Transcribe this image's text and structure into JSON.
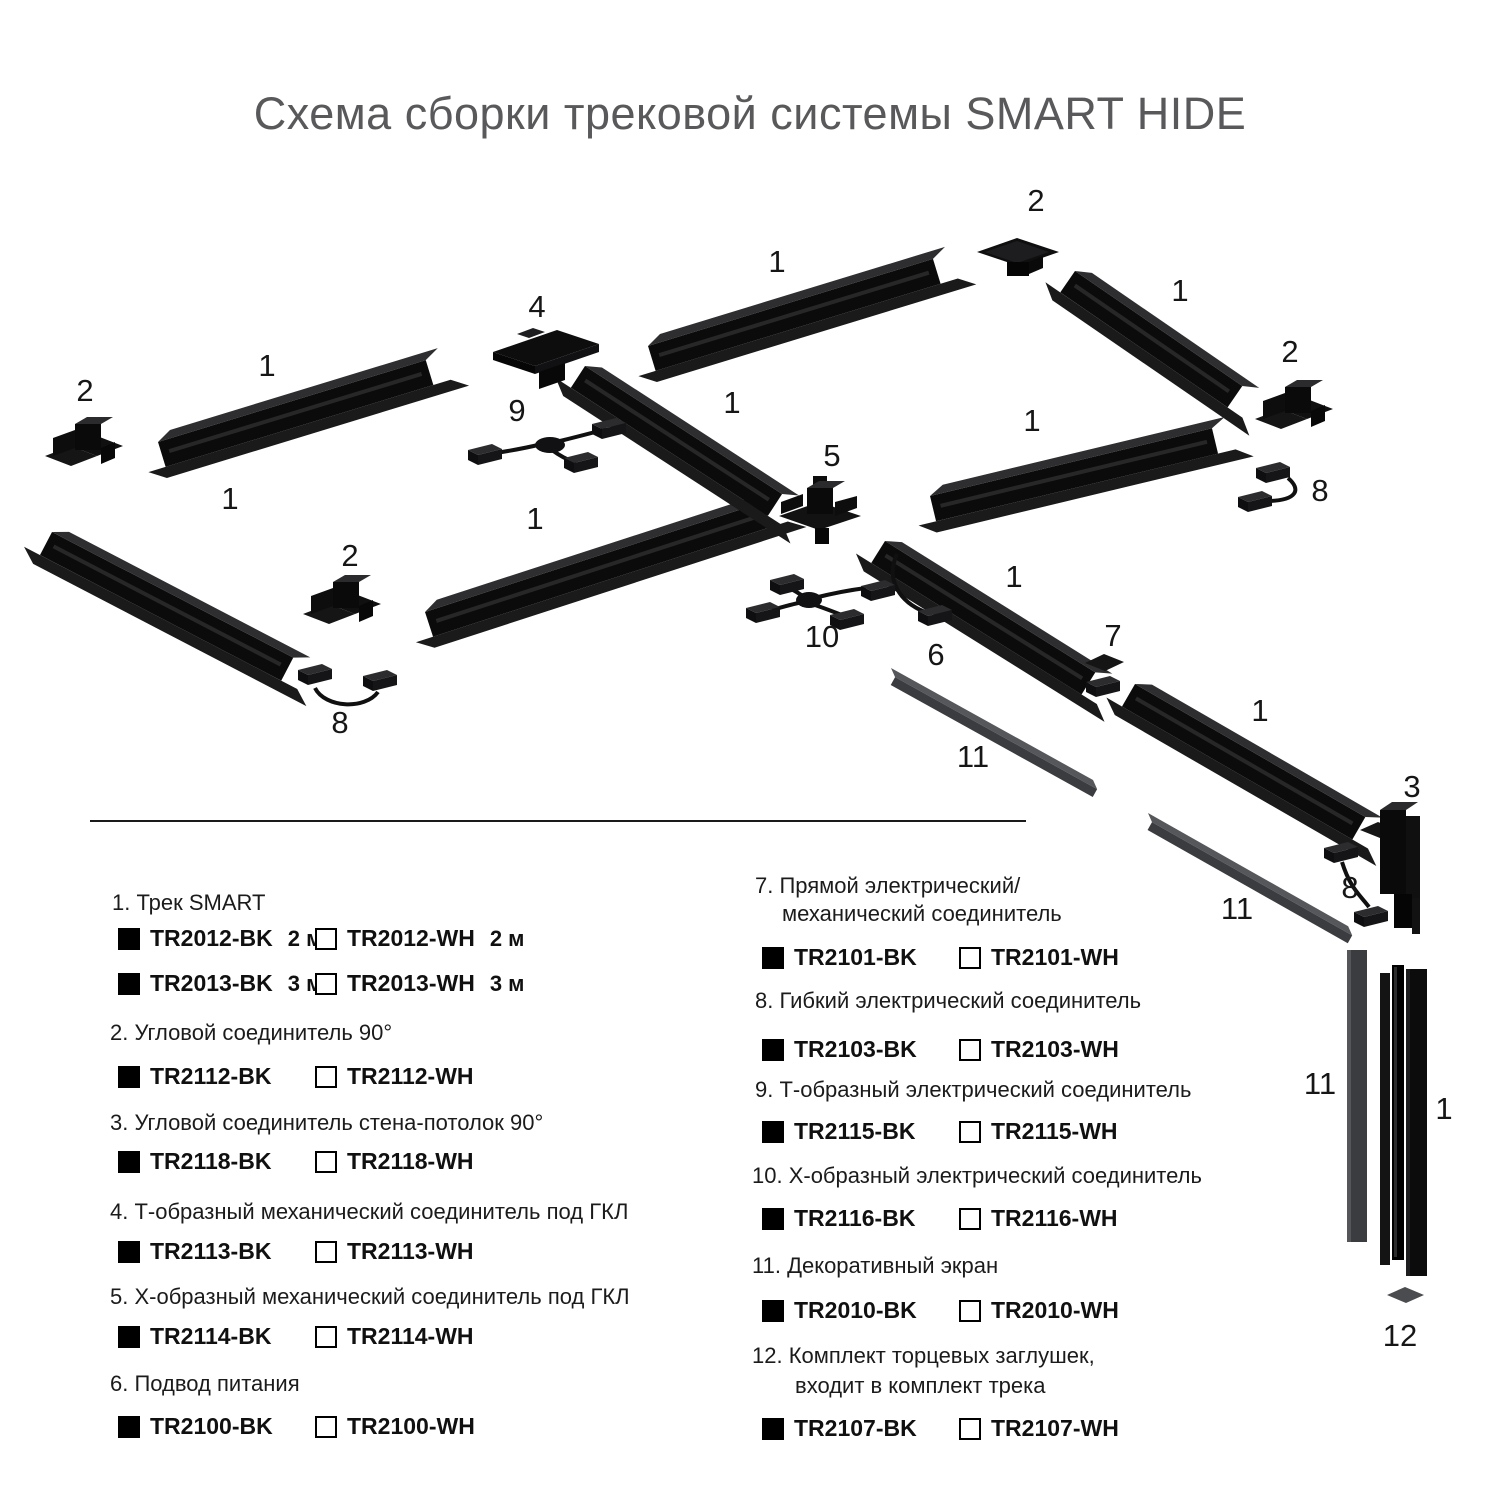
{
  "title": "Схема сборки трековой системы SMART HIDE",
  "colors": {
    "track_black": "#0b0b0b",
    "screen_gray": "#3b3c3f",
    "title_gray": "#59595b",
    "text_dark": "#1b1b1b"
  },
  "diagram": {
    "labels": [
      {
        "text": "2"
      },
      {
        "text": "1"
      },
      {
        "text": "1"
      },
      {
        "text": "4"
      },
      {
        "text": "2"
      },
      {
        "text": "1"
      },
      {
        "text": "2"
      },
      {
        "text": "1"
      },
      {
        "text": "9"
      },
      {
        "text": "1"
      },
      {
        "text": "5"
      },
      {
        "text": "8"
      },
      {
        "text": "1"
      },
      {
        "text": "1"
      },
      {
        "text": "2"
      },
      {
        "text": "1"
      },
      {
        "text": "7"
      },
      {
        "text": "10"
      },
      {
        "text": "6"
      },
      {
        "text": "1"
      },
      {
        "text": "8"
      },
      {
        "text": "11"
      },
      {
        "text": "3"
      },
      {
        "text": "8"
      },
      {
        "text": "11"
      },
      {
        "text": "11"
      },
      {
        "text": "1"
      },
      {
        "text": "12"
      }
    ]
  },
  "legend": {
    "left": [
      {
        "name": "1. Трек SMART",
        "rows": [
          {
            "bk": "TR2012-BK",
            "bk_size": "2 м",
            "wh": "TR2012-WH",
            "wh_size": "2 м"
          },
          {
            "bk": "TR2013-BK",
            "bk_size": "3 м",
            "wh": "TR2013-WH",
            "wh_size": "3 м"
          }
        ]
      },
      {
        "name": "2. Угловой соединитель 90°",
        "rows": [
          {
            "bk": "TR2112-BK",
            "wh": "TR2112-WH"
          }
        ]
      },
      {
        "name": "3. Угловой соединитель стена-потолок 90°",
        "rows": [
          {
            "bk": "TR2118-BK",
            "wh": "TR2118-WH"
          }
        ]
      },
      {
        "name": "4. Т-образный механический соединитель под ГКЛ",
        "rows": [
          {
            "bk": "TR2113-BK",
            "wh": "TR2113-WH"
          }
        ]
      },
      {
        "name": "5. Х-образный механический соединитель под ГКЛ",
        "rows": [
          {
            "bk": "TR2114-BK",
            "wh": "TR2114-WH"
          }
        ]
      },
      {
        "name": "6. Подвод питания",
        "rows": [
          {
            "bk": "TR2100-BK",
            "wh": "TR2100-WH"
          }
        ]
      }
    ],
    "right": [
      {
        "name": "7. Прямой электрический/",
        "name2": "механический соединитель",
        "rows": [
          {
            "bk": "TR2101-BK",
            "wh": "TR2101-WH"
          }
        ]
      },
      {
        "name": "8. Гибкий электрический соединитель",
        "rows": [
          {
            "bk": "TR2103-BK",
            "wh": "TR2103-WH"
          }
        ]
      },
      {
        "name": "9. Т-образный электрический соединитель",
        "rows": [
          {
            "bk": "TR2115-BK",
            "wh": "TR2115-WH"
          }
        ]
      },
      {
        "name": "10. Х-образный электрический соединитель",
        "rows": [
          {
            "bk": "TR2116-BK",
            "wh": "TR2116-WH"
          }
        ]
      },
      {
        "name": "11. Декоративный экран",
        "rows": [
          {
            "bk": "TR2010-BK",
            "wh": "TR2010-WH"
          }
        ]
      },
      {
        "name": "12. Комплект торцевых заглушек,",
        "name2": "входит в комплект трека",
        "rows": [
          {
            "bk": "TR2107-BK",
            "wh": "TR2107-WH"
          }
        ]
      }
    ]
  }
}
